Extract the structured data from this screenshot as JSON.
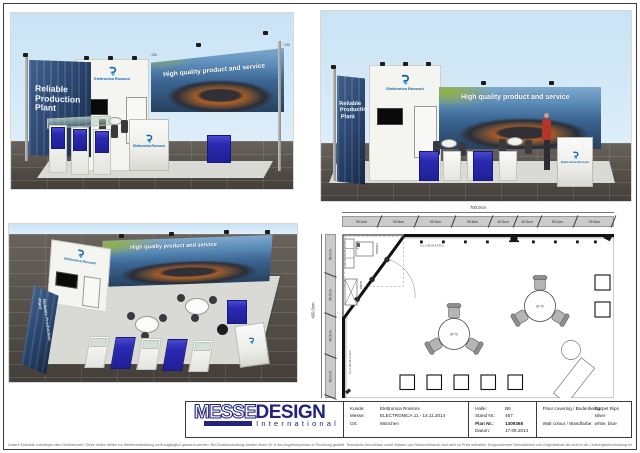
{
  "booth": {
    "banner_text": "High quality product and service",
    "side_wall_text": "Reliable Production Plant",
    "brand_name": "Elettronica Rossoni",
    "height_note_a": "+250",
    "height_note_b": "+250"
  },
  "floorplan": {
    "width_total": "700.0cm",
    "width_segments": [
      "99.0cm",
      "99.5cm",
      "99.0cm",
      "99.5cm",
      "49.5cm",
      "49.5cm",
      "99.0cm",
      "99.5cm"
    ],
    "height_total": "400.0cm",
    "height_segments": [
      "99.0cm",
      "99.5cm",
      "99.5cm",
      "99.0cm"
    ],
    "illuminated_label": "ILLUMINATED",
    "fridge_label": "FRIDGE",
    "rack_label": "RACK",
    "shelf_label": "SHELF",
    "table_diameter": "Ø 70"
  },
  "titleblock": {
    "brand_part1": "MESSE",
    "brand_part2": "DESIGN",
    "brand_subtitle": "International",
    "left_fields": [
      {
        "label": "Kunde:",
        "value": "Elettronica Rossoni"
      },
      {
        "label": "Messe:",
        "value": "ELECTRONICA  11.- 14.11.2014"
      },
      {
        "label": "Ort:",
        "value": "München"
      }
    ],
    "mid_fields": [
      {
        "label": "Halle:",
        "value": "B6"
      },
      {
        "label": "Stand Nr.:",
        "value": "467"
      },
      {
        "label": "Plan Nr.:",
        "value": "1409368"
      },
      {
        "label": "Datum:",
        "value": "17.09.2014"
      }
    ],
    "right_fields": [
      {
        "label": "Floor covering / Bodenbelag:",
        "value": "Carpet Rips"
      },
      {
        "label": "",
        "value": "silver"
      },
      {
        "label": "Wall colour / Wandfarbe:",
        "value": "white, blue"
      }
    ]
  },
  "disclaimer": "Unsere Entwürfe unterliegen dem Urheberrecht. Diese dürfen dritten zur Weiterverarbeitung nicht zugänglich gemacht werden. Bei Zuwiderhandlung werden Ihnen 40 % des Angebotspreises in Rechnung gestellt. Technische Anschlüsse sowie Wasser und Stromverbrauch sind nicht im Preis enthalten. Eingezeichnete Dekorationen und Gegenstände die nicht in der Leistungsbeschreibung enthalten sind, gehören nicht zum Lieferumfang. Änderungen durch die Messe bleiben vorbehalten.",
  "colors": {
    "navy": "#23237e",
    "banner_blue": "#4a7fae",
    "cube_blue": "#2a2ab2",
    "logo_blue": "#1565a8",
    "logo_light_blue": "#44a6d8",
    "sky_blue": "#cfe7f7"
  }
}
